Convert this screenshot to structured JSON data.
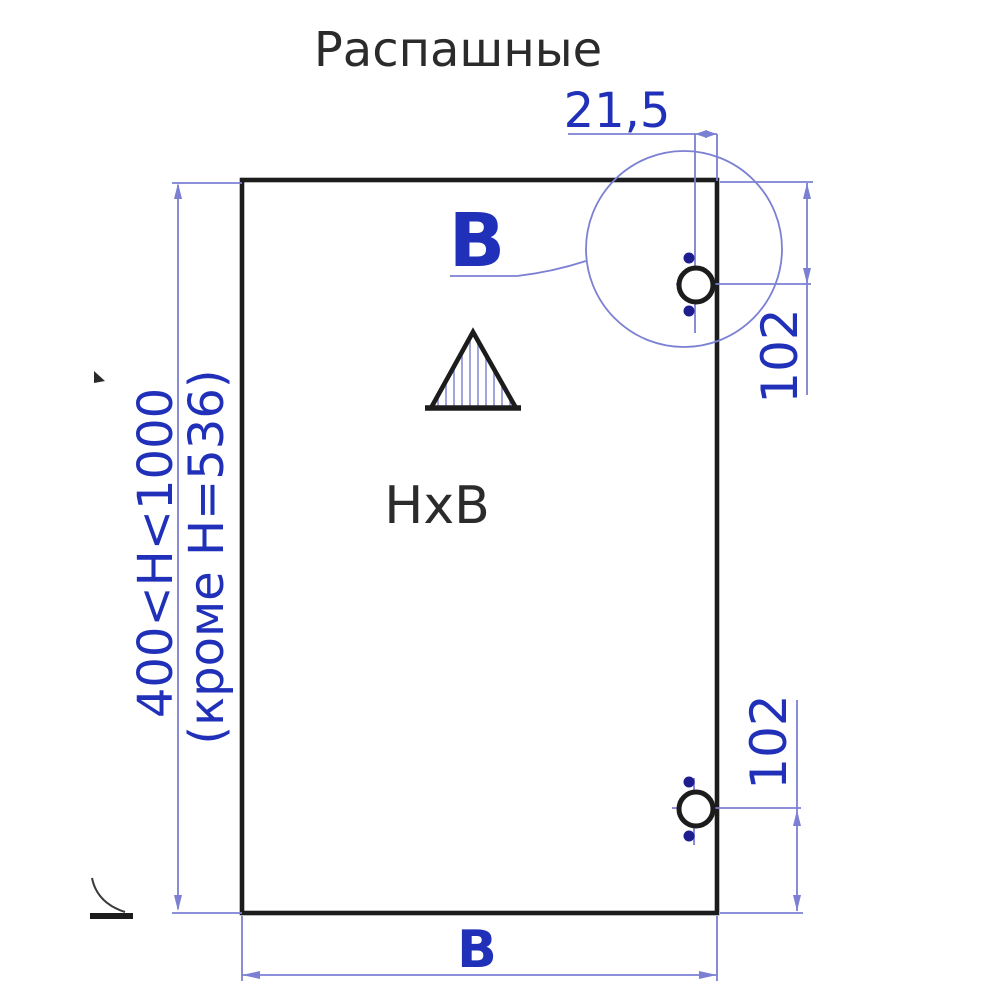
{
  "title": "Распашные",
  "drawing": {
    "panel_label": "HxB",
    "width_dim_label": "B",
    "detail_label": "B",
    "hinge_offset_dim": "21,5",
    "hinge_top_dim": "102",
    "hinge_bottom_dim": "102",
    "height_range_line1": "400<H<1000",
    "height_range_line2": "(кроме H=536)"
  },
  "colors": {
    "bg": "#ffffff",
    "line-black": "#1c1c1c",
    "line-blue": "#7b80d2",
    "hatch-blue": "#8a8fd8",
    "dot-navy": "#1d1d90",
    "text-dark": "#2b2b2b",
    "text-blue": "#2030b8"
  }
}
